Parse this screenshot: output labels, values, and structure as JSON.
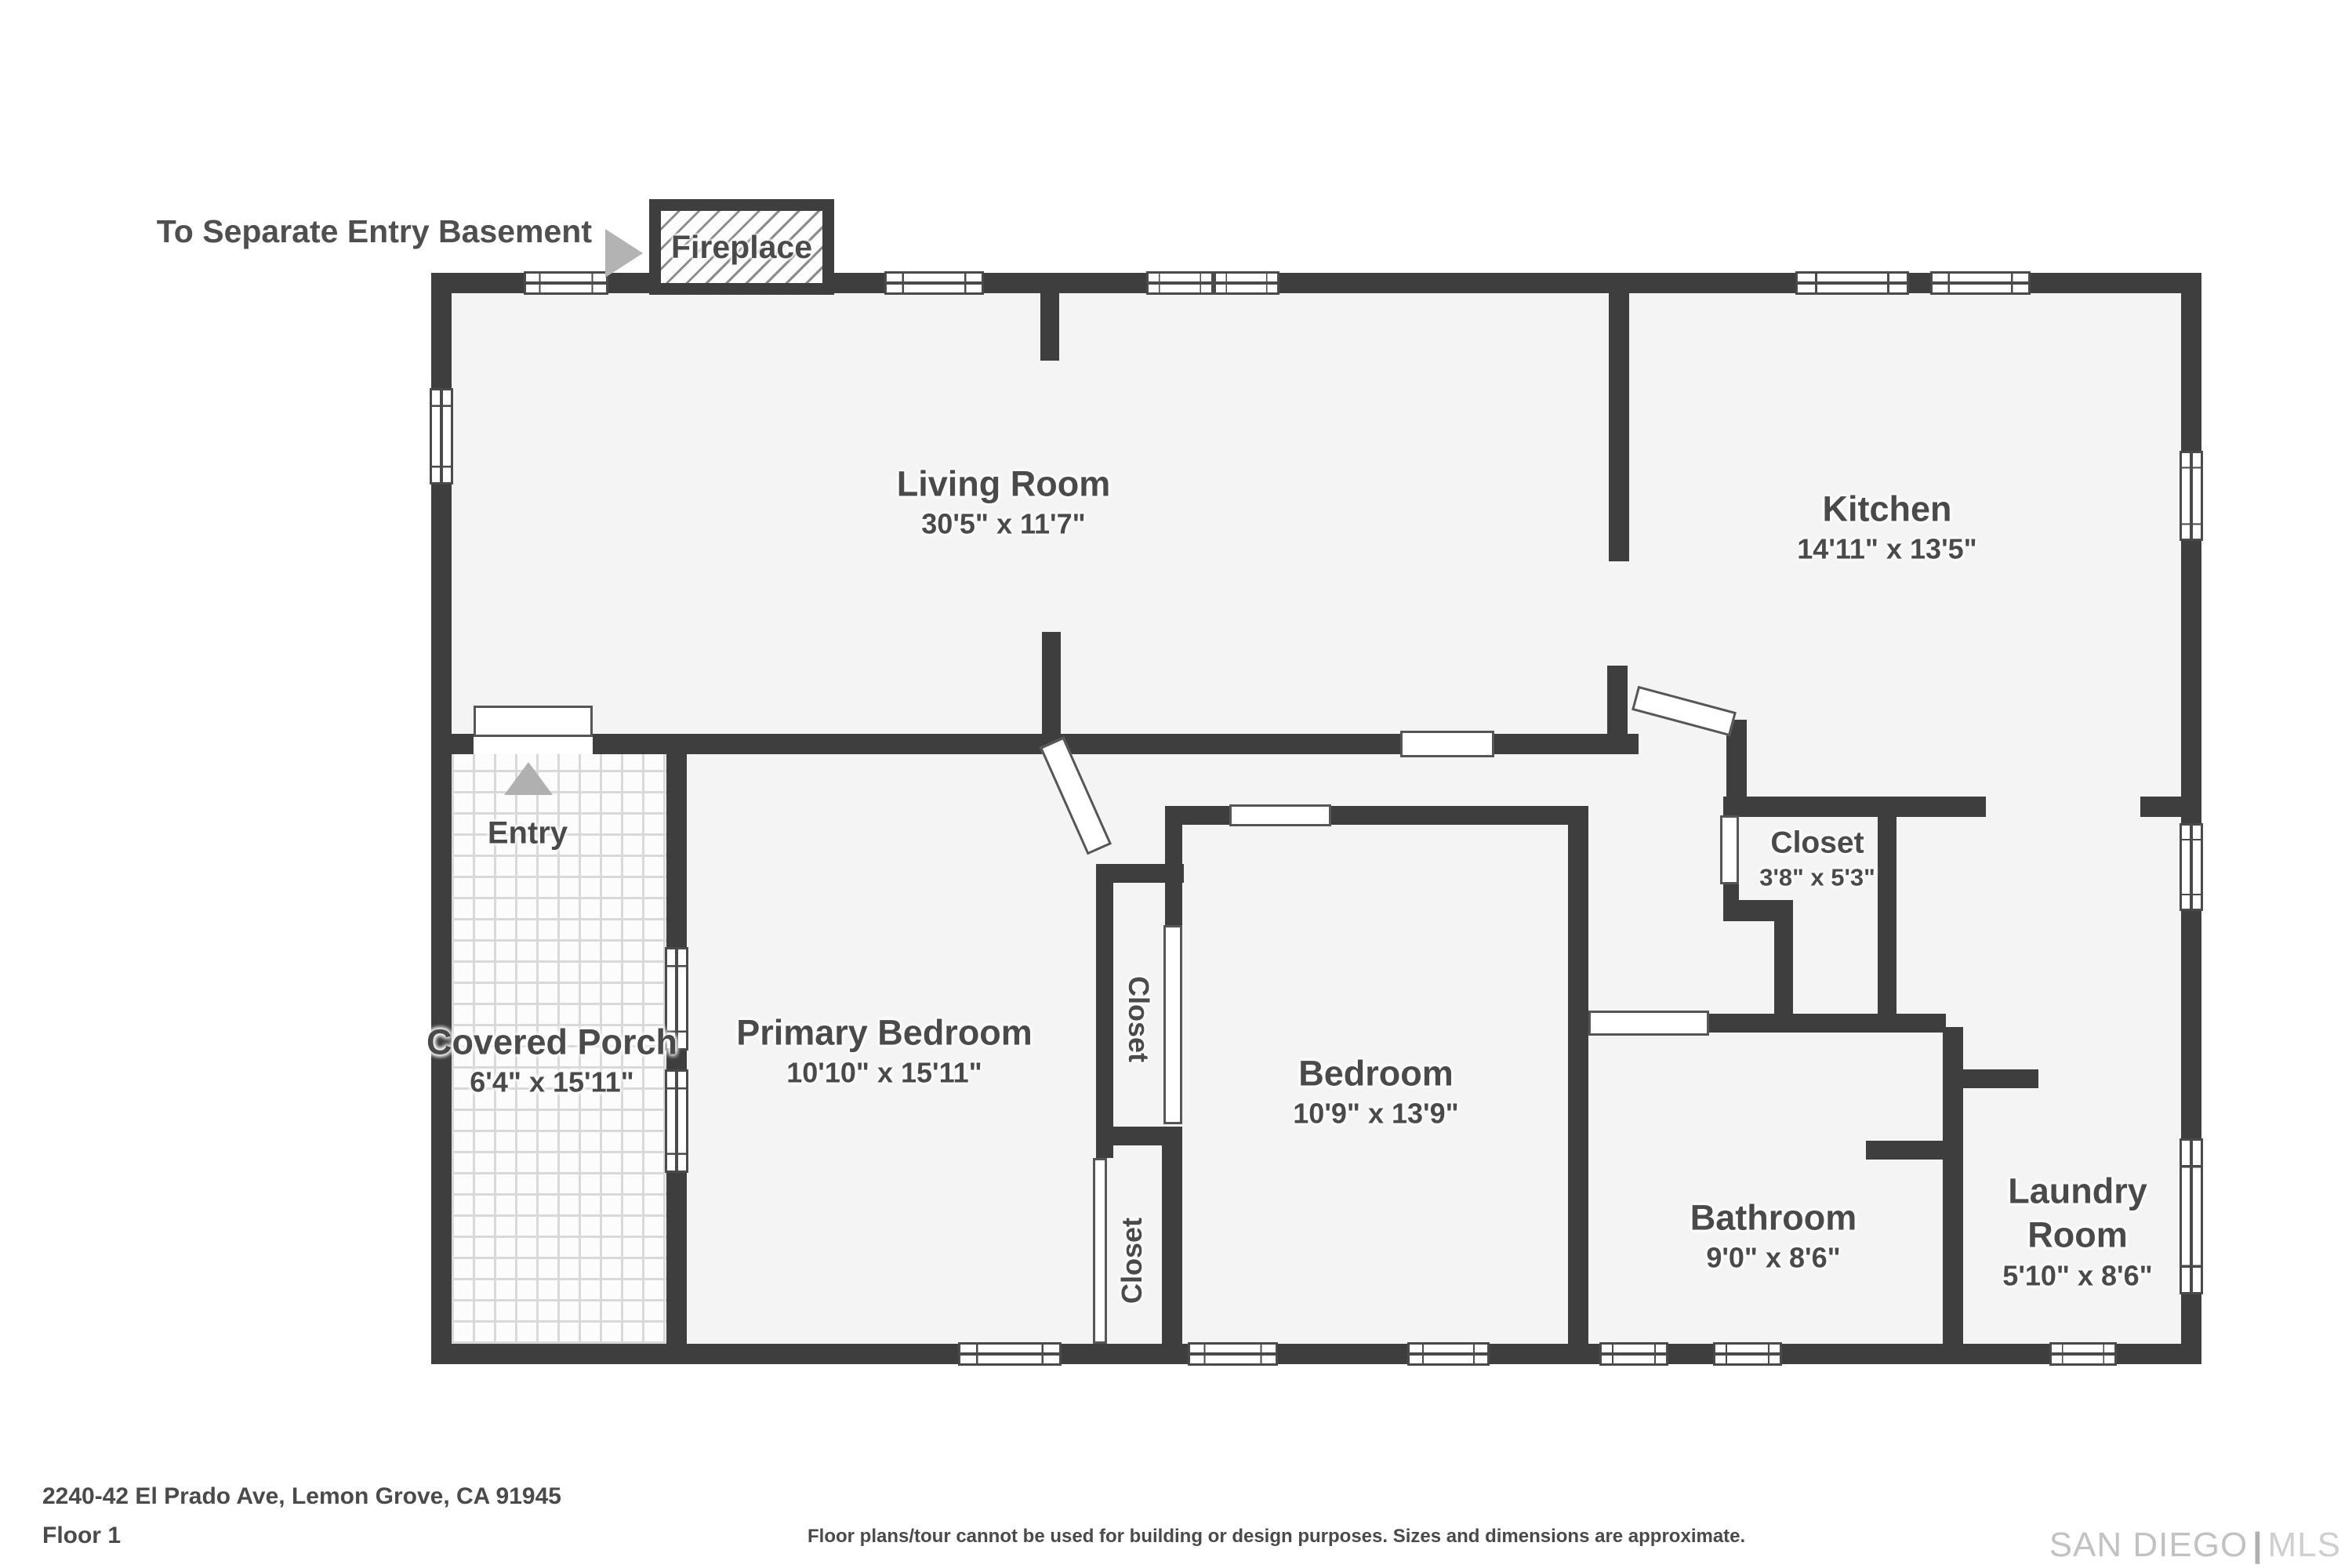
{
  "note": {
    "basement": "To Separate Entry Basement"
  },
  "fireplace": {
    "label": "Fireplace"
  },
  "rooms": [
    {
      "id": "living-room",
      "name": "Living Room",
      "dims": "30'5\" x 11'7\""
    },
    {
      "id": "kitchen",
      "name": "Kitchen",
      "dims": "14'11\" x 13'5\""
    },
    {
      "id": "primary-bedroom",
      "name": "Primary Bedroom",
      "dims": "10'10\" x 15'11\""
    },
    {
      "id": "bedroom",
      "name": "Bedroom",
      "dims": "10'9\" x 13'9\""
    },
    {
      "id": "closet-hall",
      "name": "Closet",
      "dims": "3'8\" x 5'3\""
    },
    {
      "id": "bathroom",
      "name": "Bathroom",
      "dims": "9'0\" x 8'6\""
    },
    {
      "id": "laundry-room",
      "name": "Laundry Room",
      "dims": "5'10\" x 8'6\""
    },
    {
      "id": "covered-porch",
      "name": "Covered Porch",
      "dims": "6'4\" x 15'11\""
    }
  ],
  "labels": {
    "entry": "Entry",
    "closet_upper": "Closet",
    "closet_lower": "Closet"
  },
  "footer": {
    "address": "2240-42 El Prado Ave, Lemon Grove, CA 91945",
    "floor": "Floor 1",
    "disclaimer": "Floor plans/tour cannot be used for building or design purposes. Sizes and dimensions are approximate.",
    "logo_primary": "SAN DIEGO",
    "logo_divider": "|",
    "logo_secondary": "MLS"
  },
  "colors": {
    "wall": "#3e3e3e",
    "floor": "#f4f4f4",
    "text": "#4a4a4a",
    "arrow": "#b3b3b3",
    "logo": "#c2c2c2"
  }
}
